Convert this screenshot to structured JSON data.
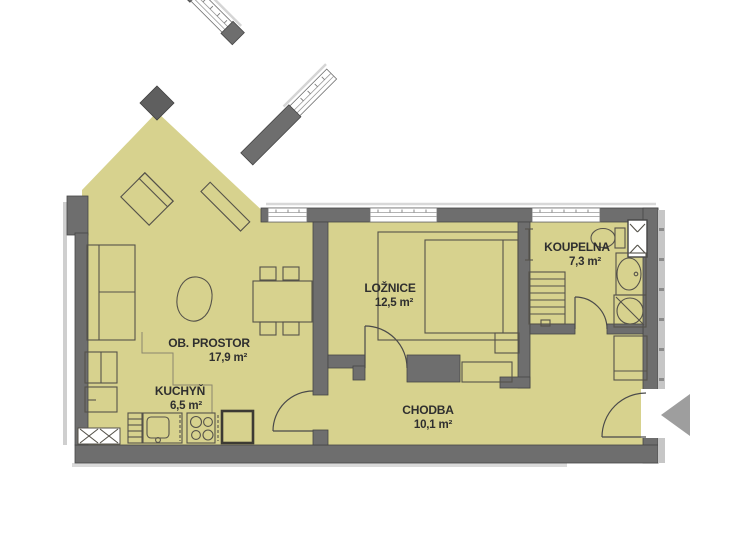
{
  "plan": {
    "rooms": {
      "ob_prostor": {
        "name": "OB. PROSTOR",
        "area": "17,9 m²"
      },
      "kuchyn": {
        "name": "KUCHYŇ",
        "area": "6,5 m²"
      },
      "loznice": {
        "name": "LOŽNICE",
        "area": "12,5 m²"
      },
      "chodba": {
        "name": "CHODBA",
        "area": "10,1 m²"
      },
      "koupelna": {
        "name": "KOUPELNA",
        "area": "7,3 m²"
      }
    },
    "colors": {
      "floor": "#d7d28e",
      "wall": "#6e6e6e",
      "label": "#2f2f2f",
      "arrow": "#9e9e9e"
    }
  }
}
